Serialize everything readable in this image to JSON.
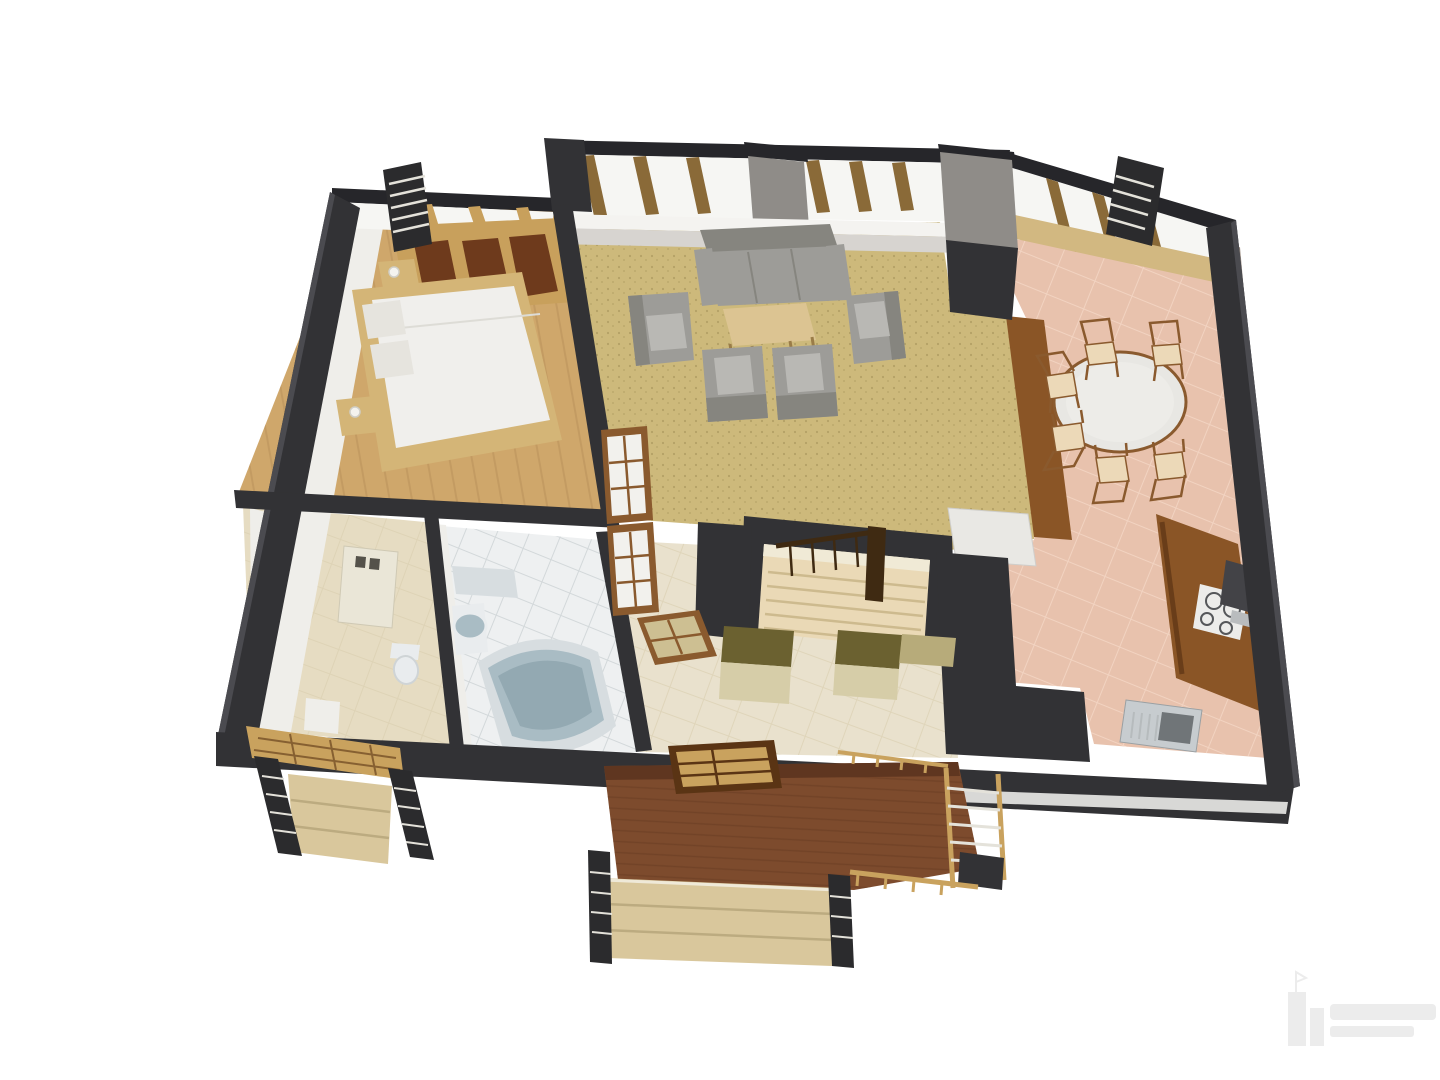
{
  "scene": {
    "description": "3D cutaway floor plan render of an apartment viewed from above at an angle on a white background",
    "rooms": [
      {
        "name": "Bedroom",
        "position": "top-left",
        "floor": "wood planks",
        "contents": [
          "double bed with white duvet",
          "two pillows",
          "nightstand with lamp x2",
          "built-in wardrobe with dark brown panels",
          "french balcony railing"
        ]
      },
      {
        "name": "Living room",
        "position": "top-center",
        "floor": "speckled cork",
        "contents": [
          "three-seat gray sofa",
          "coffee table",
          "gray armchair x4",
          "floor-to-ceiling windows with wooden mullions",
          "gray pillar"
        ]
      },
      {
        "name": "Dining room",
        "position": "right",
        "floor": "terracotta tile",
        "contents": [
          "round dining table",
          "dining chair x6",
          "tall brown cabinet",
          "french balcony railing"
        ]
      },
      {
        "name": "Kitchen",
        "position": "bottom-right",
        "floor": "terracotta tile",
        "contents": [
          "brown counter",
          "cooktop with 4 burners",
          "dark appliance",
          "sink with drainboard",
          "white cabinet"
        ]
      },
      {
        "name": "Bathroom",
        "position": "bottom-center-left",
        "floor": "white tile",
        "contents": [
          "corner bathtub",
          "washbasin",
          "shelf"
        ]
      },
      {
        "name": "Utility room",
        "position": "bottom-left",
        "floor": "beige stone tile",
        "contents": [
          "wall-mounted water heater",
          "toilet"
        ]
      },
      {
        "name": "Hallway",
        "position": "bottom-center",
        "floor": "beige tile",
        "contents": [
          "closet x2",
          "glazed double door",
          "open glazed door"
        ]
      },
      {
        "name": "Staircase",
        "position": "center",
        "contents": [
          "beige steps",
          "dark wood railing with balusters"
        ]
      },
      {
        "name": "Terrace",
        "position": "bottom",
        "contents": [
          "brown deck",
          "wood railings",
          "wide entry steps",
          "dark step railings",
          "open slatted door"
        ]
      },
      {
        "name": "Side entrance",
        "position": "bottom-left",
        "contents": [
          "wood lattice porch",
          "steps",
          "dark railings with light rungs"
        ]
      }
    ]
  },
  "watermark": {
    "present": true,
    "legible": false,
    "position": "bottom-right"
  },
  "colors": {
    "background": "#ffffff",
    "wall_dark": "#323235",
    "wall_darker": "#26262a",
    "wall_edge": "#4b4b50",
    "wall_face": "#efeeea",
    "wall_face_warm": "#a3968c",
    "pillar": "#8f8c88",
    "glass": "#f6f6f3",
    "sill_white": "#f4f3f0",
    "sill_shadow": "#d7d4d0",
    "plinth": "#d8d8d6",
    "mullion": "#8a6a38",
    "wood_frame": "#c8a05c",
    "sill_tan": "#d2b881",
    "shutter": "#6e3a1c",
    "floor_bedroom": "#cfa76b",
    "plank": "#b7905a",
    "floor_living": "#cdb97b",
    "speckle": "#8f7d45",
    "floor_dining": "#e8c2ad",
    "tile_pink_line": "#f3d6c4",
    "floor_bath": "#eef0f1",
    "tile_white_line": "#ccd2d5",
    "floor_utility": "#e6dcc2",
    "floor_hall": "#e9e1cd",
    "tile_beige_line": "#d8cdae",
    "bed_frame": "#d4b577",
    "bed_white": "#f0efec",
    "pillow": "#e6e4de",
    "duvet_fold": "#dddcd6",
    "sofa": "#9d9c98",
    "sofa_dark": "#86857f",
    "sofa_light": "#b9b8b4",
    "coffee_table": "#dcc492",
    "table_leg": "#9a7c48",
    "dining_table": "#e8e7e3",
    "dining_table_inner": "#edece8",
    "chair_wood": "#8a5a2e",
    "chair_seat": "#ecd9b8",
    "cabinet_white": "#e9e8e4",
    "counter": "#8a5526",
    "counter_dark": "#693d19",
    "cooktop": "#ececea",
    "burner": "#55575a",
    "appliance": "#434347",
    "appliance_shelf": "#b9bcbe",
    "steel": "#c7cccf",
    "sink_basin": "#707578",
    "sink_rib": "#b6bbbd",
    "tub_rim": "#d7dde0",
    "tub": "#a9bcc4",
    "tub_deep": "#93a9b2",
    "ceramic": "#e9ecee",
    "ceramic_line": "#cfd4d6",
    "boiler": "#eae6d7",
    "boiler_vent": "#55524a",
    "closet_olive": "#6b6130",
    "closet_front": "#d6cda8",
    "closet_beige": "#b7ab7a",
    "stair_tread": "#ead9b6",
    "stair_line": "#cdba8e",
    "stair_top": "#f0ead6",
    "stair_rail": "#3f2a12",
    "deck": "#7d4b2d",
    "deck_dark": "#5f3620",
    "deck_line": "#6a3c22",
    "rail_wood": "#c9a25e",
    "rail_dark": "#2b2b2d",
    "rail_rung": "#e4e2da",
    "step_beige": "#d9c79c",
    "step_line": "#bcab80",
    "step_edge": "#efe9d8",
    "pane_white": "#f2f1ed",
    "pane_tan": "#cdbf92",
    "door_frame": "#5a3414",
    "lamp": "#f4f3ef",
    "lamp_edge": "#d0cfc8",
    "watermark": "#ececec"
  }
}
